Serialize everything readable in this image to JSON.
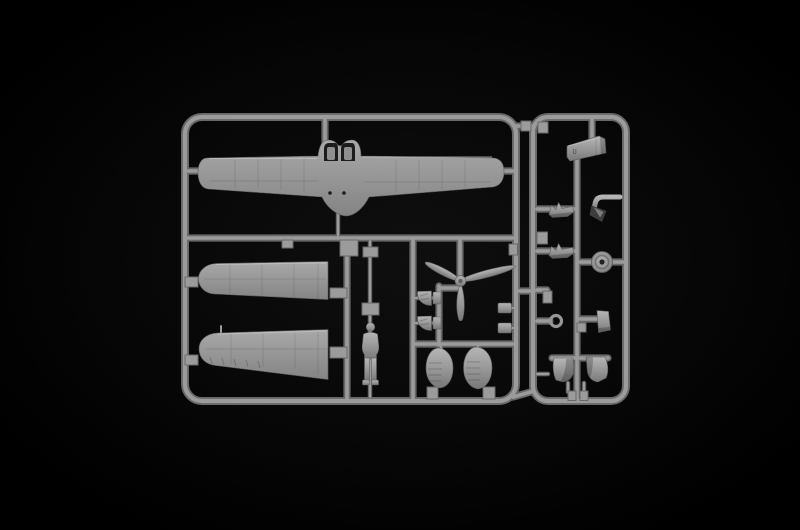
{
  "scene": {
    "type": "photograph",
    "subject": "Injection-molded light grey polystyrene sprue (parts tree) from a small-scale model aircraft kit",
    "setting": "studio photo on a plain black background",
    "plastic_finish": "matt light grey styrene"
  },
  "colors": {
    "background": "#000000",
    "vignette": "#0f0f0f",
    "plastic_highlight": "#b5b5b5",
    "plastic_mid": "#969696",
    "plastic_shadow": "#787878",
    "runner_edge": "#676767",
    "runner_core": "#9b9b9b",
    "recess_dark": "#1d1d1d",
    "part_shadow": "#3e3e3e"
  },
  "markings": {
    "cowling_mark": "U"
  },
  "parts": [
    {
      "name": "one-piece-wing",
      "label": "One-piece lower wing with cockpit floor and two seats"
    },
    {
      "name": "upper-wing-half-1",
      "label": "Upper wing half"
    },
    {
      "name": "upper-wing-half-2",
      "label": "Upper wing half with pitot mast"
    },
    {
      "name": "pilot-figure",
      "label": "Standing pilot figure"
    },
    {
      "name": "propeller",
      "label": "Three-blade propeller with spinner"
    },
    {
      "name": "intake-fairings",
      "label": "Pair of small intake fairings"
    },
    {
      "name": "wheel-spats",
      "label": "Pair of ribbed wheel spats"
    },
    {
      "name": "engine-cowling",
      "label": "Engine cowling"
    },
    {
      "name": "exhaust-pipe",
      "label": "Bent exhaust / pipe fitting"
    },
    {
      "name": "tailplane-halves",
      "label": "Pair of small tailplane parts"
    },
    {
      "name": "main-wheel",
      "label": "Main wheel with hub"
    },
    {
      "name": "ring-part",
      "label": "Small ring part"
    },
    {
      "name": "gear-leg-covers",
      "label": "Pair of landing-gear leg covers"
    },
    {
      "name": "small-fittings",
      "label": "Assorted small fittings and mounting tabs"
    }
  ]
}
